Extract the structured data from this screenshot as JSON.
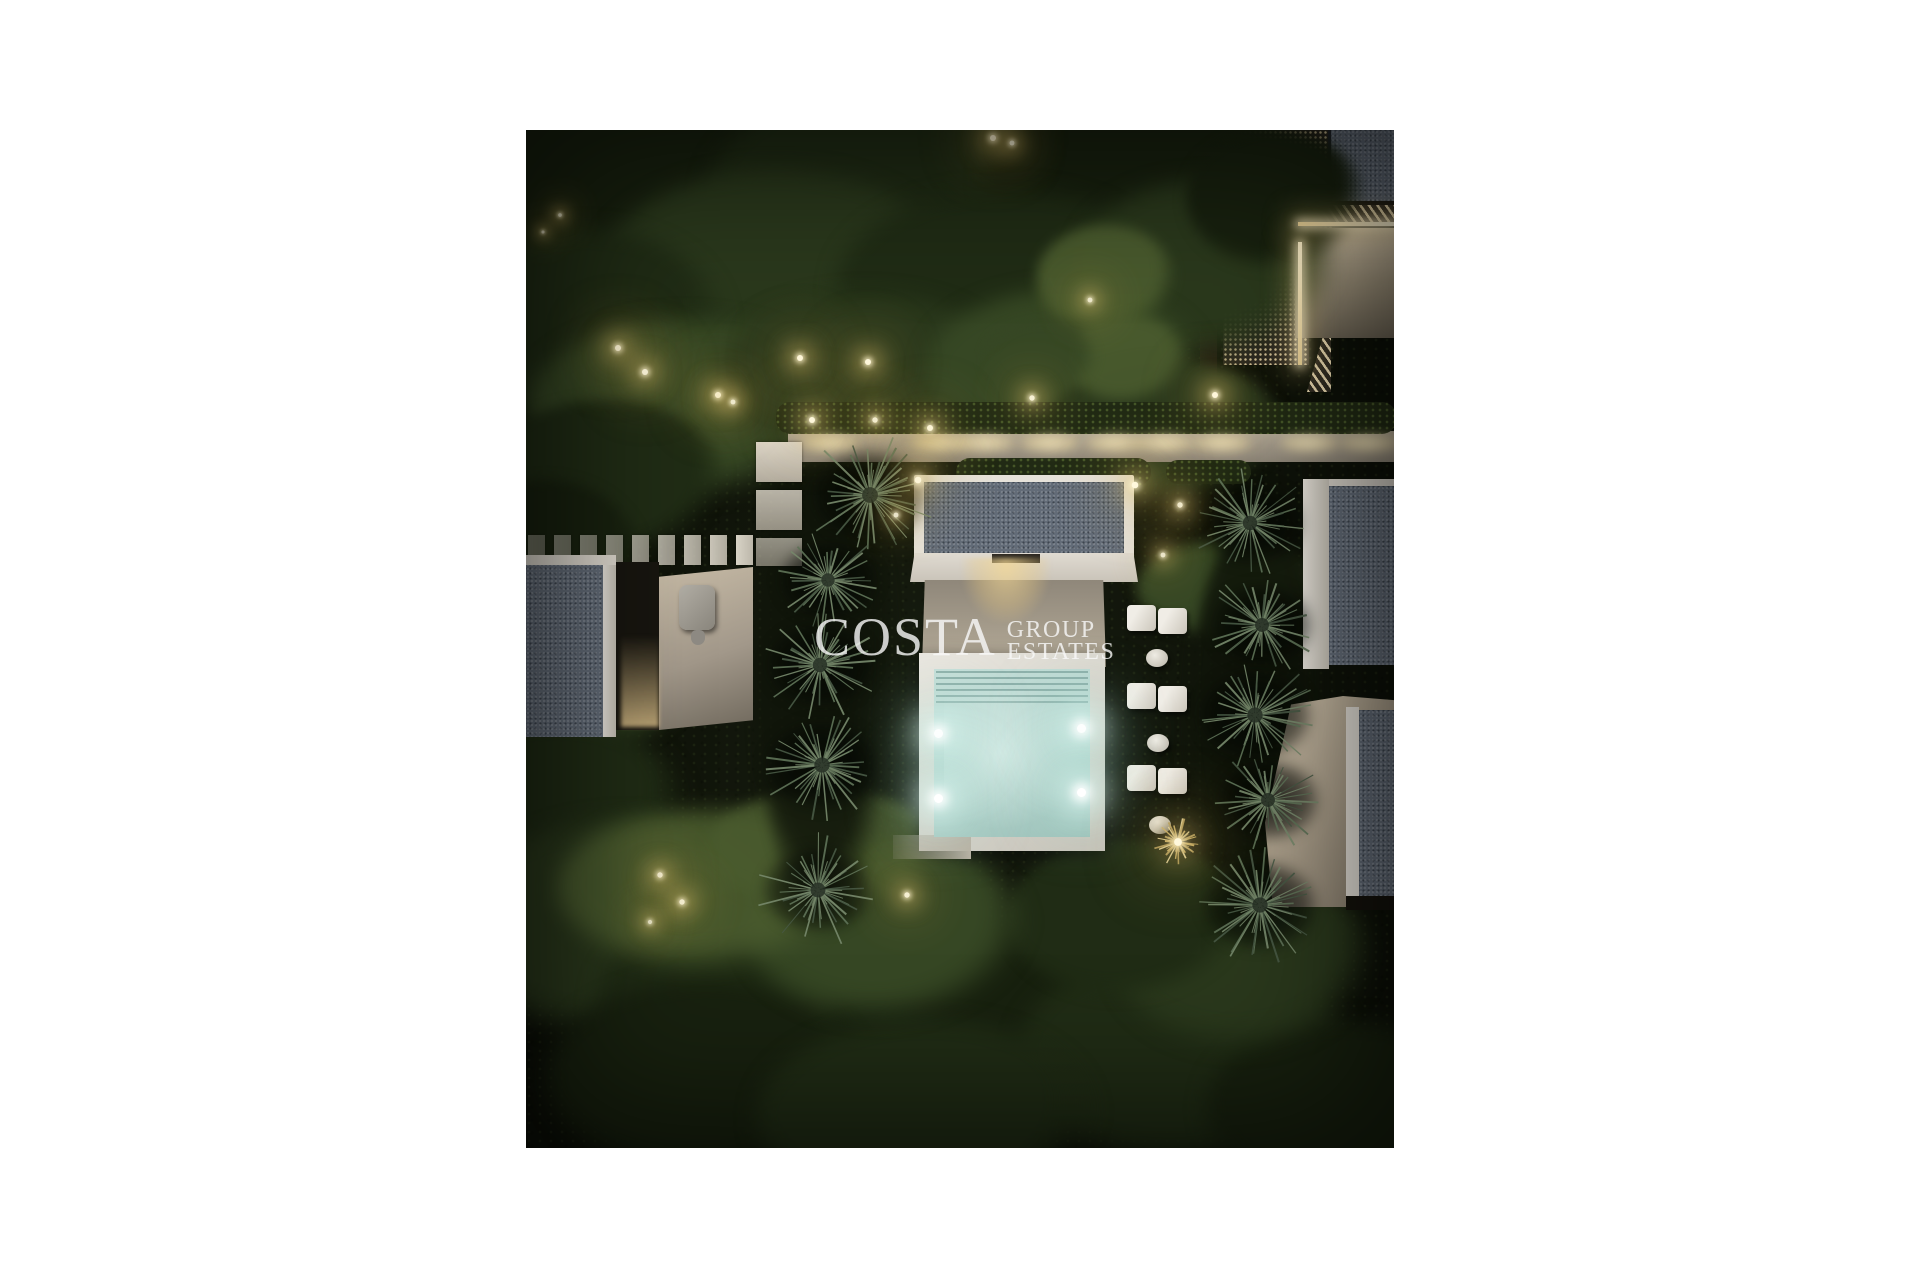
{
  "watermark": {
    "brand": "COSTA",
    "line1": "GROUP",
    "line2": "ESTATES",
    "color": "#fafafa"
  },
  "palette": {
    "page_background": "#ffffff",
    "night_ground": "#10140a",
    "gravel_roof": "#636c78",
    "white_frame": "#e6e2da",
    "beige_wall": "#b6ac99",
    "walkway": "#c9bfae",
    "pool_water": "#bcd8d2",
    "pool_steps": "#8fb5ae",
    "warm_light": "#f5e7b8",
    "palm_green": "#5e7257",
    "canopy_dark": "#18210f"
  },
  "scene": {
    "canopy_colors": [
      "#10150a",
      "#18210f",
      "#202c15",
      "#2a381c",
      "#364724",
      "#4a5b2e"
    ],
    "canopies": [
      [
        120,
        60,
        190,
        110,
        1,
        1
      ],
      [
        380,
        70,
        200,
        120,
        2,
        1
      ],
      [
        620,
        50,
        160,
        100,
        1,
        1
      ],
      [
        250,
        150,
        180,
        110,
        3,
        1
      ],
      [
        60,
        200,
        140,
        100,
        2,
        1
      ],
      [
        480,
        160,
        170,
        100,
        2,
        1
      ],
      [
        680,
        140,
        130,
        90,
        3,
        1
      ],
      [
        750,
        70,
        90,
        70,
        1,
        1
      ],
      [
        160,
        280,
        160,
        90,
        4,
        1
      ],
      [
        340,
        250,
        150,
        85,
        3,
        1
      ],
      [
        540,
        240,
        140,
        80,
        4,
        1
      ],
      [
        640,
        300,
        120,
        70,
        3,
        1
      ],
      [
        80,
        350,
        120,
        80,
        2,
        1
      ],
      [
        20,
        440,
        100,
        90,
        1,
        1
      ],
      [
        60,
        560,
        110,
        70,
        3,
        1
      ],
      [
        30,
        680,
        130,
        90,
        2,
        1
      ],
      [
        100,
        800,
        170,
        110,
        3,
        1
      ],
      [
        260,
        880,
        190,
        120,
        2,
        1
      ],
      [
        480,
        900,
        180,
        110,
        1,
        1
      ],
      [
        660,
        930,
        170,
        110,
        2,
        1
      ],
      [
        820,
        980,
        140,
        90,
        1,
        1
      ],
      [
        180,
        950,
        160,
        100,
        1,
        1
      ],
      [
        400,
        990,
        170,
        100,
        2,
        1
      ],
      [
        720,
        830,
        130,
        90,
        3,
        1
      ],
      [
        600,
        790,
        120,
        80,
        2,
        1
      ],
      [
        360,
        800,
        140,
        90,
        4,
        1
      ],
      [
        180,
        760,
        150,
        80,
        5,
        0.9
      ],
      [
        300,
        720,
        120,
        60,
        5,
        0.8
      ],
      [
        580,
        150,
        70,
        55,
        5,
        0.95
      ],
      [
        600,
        230,
        60,
        45,
        5,
        0.9
      ],
      [
        515,
        230,
        55,
        40,
        4,
        0.9
      ],
      [
        700,
        460,
        90,
        50,
        4,
        1
      ],
      [
        733,
        590,
        70,
        200,
        0,
        0.85
      ],
      [
        300,
        560,
        70,
        230,
        0,
        0.85
      ]
    ],
    "garden_lights": [
      [
        92,
        218,
        1
      ],
      [
        119,
        242,
        1
      ],
      [
        192,
        265,
        1
      ],
      [
        207,
        272,
        0.8
      ],
      [
        274,
        228,
        1
      ],
      [
        286,
        290,
        1
      ],
      [
        342,
        232,
        1
      ],
      [
        349,
        290,
        0.9
      ],
      [
        404,
        298,
        1
      ],
      [
        467,
        8,
        1
      ],
      [
        486,
        13,
        0.8
      ],
      [
        564,
        170,
        0.8
      ],
      [
        506,
        268,
        0.9
      ],
      [
        689,
        265,
        1
      ],
      [
        654,
        375,
        0.9
      ],
      [
        637,
        425,
        0.8
      ],
      [
        392,
        350,
        1.1
      ],
      [
        609,
        355,
        1.1
      ],
      [
        134,
        745,
        0.9
      ],
      [
        156,
        772,
        0.9
      ],
      [
        124,
        792,
        0.7
      ],
      [
        381,
        765,
        0.9
      ],
      [
        34,
        85,
        0.6
      ],
      [
        17,
        102,
        0.5
      ],
      [
        370,
        385,
        0.8
      ]
    ],
    "walkway_glow_xs": [
      304,
      414,
      459,
      524,
      589,
      639,
      696,
      784,
      844
    ],
    "palm_colors": [
      "#5e7257",
      "#475844",
      "#76886b"
    ],
    "palms": [
      [
        344,
        365,
        66
      ],
      [
        302,
        450,
        56
      ],
      [
        294,
        535,
        60
      ],
      [
        296,
        635,
        64
      ],
      [
        292,
        760,
        62
      ],
      [
        724,
        393,
        60
      ],
      [
        736,
        495,
        58
      ],
      [
        729,
        585,
        64
      ],
      [
        742,
        670,
        58
      ],
      [
        734,
        775,
        64
      ]
    ],
    "pool_lights": [
      [
        412,
        603
      ],
      [
        412,
        668
      ],
      [
        555,
        598
      ],
      [
        555,
        662
      ]
    ],
    "lounger_groups": [
      [
        601,
        475
      ],
      [
        601,
        553
      ],
      [
        601,
        635
      ]
    ],
    "lounger_stools": [
      [
        631,
        528
      ],
      [
        632,
        613
      ],
      [
        634,
        695
      ]
    ],
    "deck_slats": {
      "count": 9,
      "x": 2,
      "y": 405,
      "w": 17,
      "h": 30,
      "gap": 9
    },
    "stepping_pavers": [
      [
        230,
        312,
        46,
        40
      ],
      [
        230,
        360,
        46,
        40
      ],
      [
        230,
        408,
        46,
        28
      ]
    ],
    "starburst": {
      "x": 652,
      "y": 712,
      "r": 26,
      "colors": [
        "#cbb068",
        "#e8d9a4",
        "#b09a5e"
      ]
    }
  }
}
